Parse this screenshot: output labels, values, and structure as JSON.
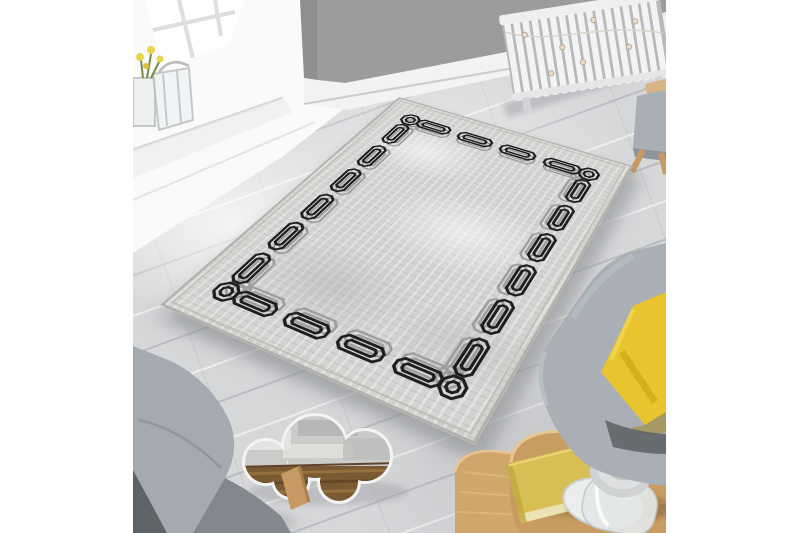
{
  "scene": {
    "kind": "product-photo",
    "setting": "living-room-top-view",
    "subject": "grey distressed area rug with black interlocking chain border",
    "canvas_background": "#ffffff"
  },
  "palette": {
    "wall_grey": "#9b9c9e",
    "wall_corner_dark": "#8e8f91",
    "baseboard_white": "#f3f3f4",
    "floor_grey": "#d6d7d9",
    "floor_seam": "#a9abaf",
    "rug_field": "#d3d3d1",
    "rug_edge": "#b3b0ab",
    "chain_black": "#1e1e1e",
    "chain_grey": "#9d9d9d",
    "chair_fabric": "#a7adb3",
    "chair_fabric_dark": "#82888e",
    "chair_shadow_dark": "#5e6368",
    "pillow_yellow": "#e8c52e",
    "pillow_fold": "#c5a314",
    "table_oak": "#c89d62",
    "table_oak_light": "#cfa76b",
    "table_grain": "#dcb57e",
    "book_yellow": "#d8bf55",
    "book_pages": "#ece2b4",
    "lantern_silver": "#cfd1d2",
    "lantern_glass": "#e4e7e7",
    "mirror_rim": "#f4f4f4",
    "mirror_wood": "#7a5a33",
    "radiator_white": "#f3f3f4",
    "radiator_gap": "#b7b9bc",
    "leg_wood": "#c79a63",
    "stool_top_rattan": "#d6b487",
    "window_glass": "#ffffff",
    "muntin": "#dcdfe1"
  },
  "rug_geometry": {
    "w": 250,
    "h": 330,
    "inset": 32,
    "link_half_len": 17,
    "link_half_wid": 6.5,
    "inner_half_len": 11.5,
    "inner_half_wid": 3.2,
    "corner_half": 8.5,
    "corner_inner": 4.2,
    "echo_offset": 6,
    "stroke_black": 2.3,
    "stroke_grey": 2.0,
    "top_links": 4,
    "side_links": 6
  },
  "objects": [
    {
      "name": "window",
      "desc": "white sash window with bright daylight, top left"
    },
    {
      "name": "flower-vase",
      "desc": "glass lantern and vase with yellow flowers on windowsill"
    },
    {
      "name": "wall",
      "desc": "grey painted walls with white baseboard"
    },
    {
      "name": "radiator",
      "desc": "white column radiator with draped string lights, top right"
    },
    {
      "name": "stool",
      "desc": "grey stool with rattan top and wooden legs at right edge"
    },
    {
      "name": "rug",
      "desc": "rectangular grey rug, distressed field, black geometric chain border with grey echo"
    },
    {
      "name": "armchair-left",
      "desc": "grey fabric armchair, bottom left corner"
    },
    {
      "name": "armchair-right",
      "desc": "grey fabric armchair with mustard yellow cushion, right side"
    },
    {
      "name": "cloud-mirror",
      "desc": "cloud-shaped floor mirror reflecting rug and wood slats"
    },
    {
      "name": "nesting-tables",
      "desc": "two light oak kidney-shaped nesting coffee tables, bottom right"
    },
    {
      "name": "book",
      "desc": "yellow hardback book on table"
    },
    {
      "name": "lantern",
      "desc": "glass hurricane lantern with silver lid on table"
    }
  ]
}
